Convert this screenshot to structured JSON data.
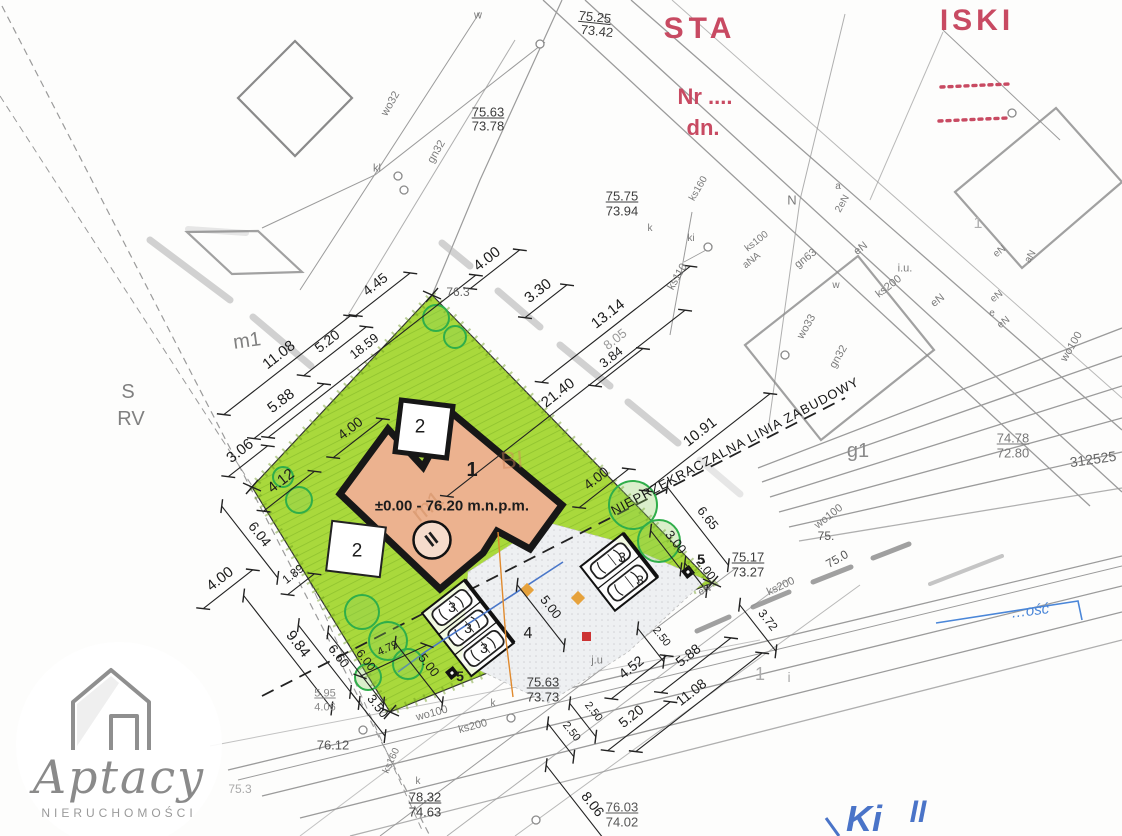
{
  "meta": {
    "title": "site-plan-scan",
    "width": 1122,
    "height": 836
  },
  "colors": {
    "plot_green": "#a9d93c",
    "hatch_green": "#8fc22e",
    "border_hatch": "#68961a",
    "building_fill": "#ecb28f",
    "outline_black": "#171717",
    "stamp_red": "#c84a62",
    "blue_ink": "#4a74c8",
    "blue_box": "#4a86d8",
    "orange_line": "#e08a2e",
    "red_marker": "#cc3333",
    "survey_gray": "#9b9b9b",
    "dim_black": "#222222"
  },
  "logo": {
    "brand": "Aptacy",
    "subtitle": "NIERUCHOMOŚCI",
    "icon": "house-icon"
  },
  "building": {
    "number": "1",
    "level_text": "±0.00 - 76.20 m.n.p.m.",
    "storey_symbol": "II",
    "terrace_labels": [
      "2",
      "2"
    ],
    "parking_stall_label": "3",
    "driveway_label": "4",
    "lamp_label": "5"
  },
  "building_line_text": "NIEPRZEKRACZALNA LINIA ZABUDOWY",
  "trees": [
    {
      "cx": 436,
      "cy": 318,
      "r": 13
    },
    {
      "cx": 455,
      "cy": 337,
      "r": 11
    },
    {
      "cx": 283,
      "cy": 477,
      "r": 10
    },
    {
      "cx": 299,
      "cy": 500,
      "r": 13
    },
    {
      "cx": 362,
      "cy": 612,
      "r": 17
    },
    {
      "cx": 388,
      "cy": 641,
      "r": 19
    },
    {
      "cx": 408,
      "cy": 664,
      "r": 15
    },
    {
      "cx": 368,
      "cy": 677,
      "r": 13
    },
    {
      "cx": 633,
      "cy": 505,
      "r": 24
    },
    {
      "cx": 659,
      "cy": 541,
      "r": 21
    }
  ],
  "manholes": [
    [
      398,
      176
    ],
    [
      404,
      190
    ],
    [
      540,
      44
    ],
    [
      708,
      247
    ],
    [
      1012,
      113
    ],
    [
      785,
      355
    ],
    [
      363,
      730
    ],
    [
      511,
      718
    ],
    [
      536,
      820
    ]
  ],
  "labels": [
    {
      "t": "STA",
      "x": 700,
      "y": 29,
      "s": 30,
      "b": 1,
      "c": "#c84a62",
      "ls": 5,
      "n": "stamp-text-sta"
    },
    {
      "t": "ISKI",
      "x": 977,
      "y": 21,
      "s": 30,
      "b": 1,
      "c": "#c84a62",
      "ls": 4,
      "n": "stamp-text-iski"
    },
    {
      "t": "Nr ....",
      "x": 705,
      "y": 97,
      "s": 22,
      "b": 1,
      "c": "#c84a62",
      "n": "stamp-nr-label"
    },
    {
      "t": "dn.",
      "x": 703,
      "y": 128,
      "s": 22,
      "b": 1,
      "c": "#c84a62",
      "n": "stamp-date-label"
    },
    {
      "t": "75.25",
      "x": 595,
      "y": 17,
      "s": 13,
      "c": "#3c3c3c",
      "u": 1,
      "r": 6,
      "n": "elevation-label"
    },
    {
      "t": "73.42",
      "x": 597,
      "y": 31,
      "s": 13,
      "c": "#3c3c3c",
      "r": 6,
      "n": "elevation-label"
    },
    {
      "t": "75.63",
      "x": 488,
      "y": 112,
      "s": 13,
      "c": "#3c3c3c",
      "u": 1,
      "n": "elevation-label"
    },
    {
      "t": "73.78",
      "x": 488,
      "y": 126,
      "s": 13,
      "c": "#3c3c3c",
      "n": "elevation-label"
    },
    {
      "t": "75.75",
      "x": 622,
      "y": 196,
      "s": 13,
      "c": "#3c3c3c",
      "u": 1,
      "n": "elevation-label"
    },
    {
      "t": "73.94",
      "x": 622,
      "y": 211,
      "s": 13,
      "c": "#3c3c3c",
      "n": "elevation-label"
    },
    {
      "t": "75.63",
      "x": 543,
      "y": 682,
      "s": 13,
      "c": "#3c3c3c",
      "u": 1,
      "n": "elevation-label"
    },
    {
      "t": "73.73",
      "x": 543,
      "y": 697,
      "s": 13,
      "c": "#3c3c3c",
      "n": "elevation-label"
    },
    {
      "t": "78.32",
      "x": 425,
      "y": 797,
      "s": 13,
      "c": "#3c3c3c",
      "u": 1,
      "n": "elevation-label"
    },
    {
      "t": "74.63",
      "x": 425,
      "y": 812,
      "s": 13,
      "c": "#3c3c3c",
      "n": "elevation-label"
    },
    {
      "t": "76.03",
      "x": 622,
      "y": 807,
      "s": 13,
      "c": "#555555",
      "u": 1,
      "n": "elevation-label"
    },
    {
      "t": "74.02",
      "x": 622,
      "y": 822,
      "s": 13,
      "c": "#555555",
      "n": "elevation-label"
    },
    {
      "t": "75.17",
      "x": 748,
      "y": 557,
      "s": 13,
      "c": "#3c3c3c",
      "u": 1,
      "n": "elevation-label"
    },
    {
      "t": "73.27",
      "x": 748,
      "y": 572,
      "s": 13,
      "c": "#3c3c3c",
      "n": "elevation-label"
    },
    {
      "t": "74.78",
      "x": 1013,
      "y": 438,
      "s": 13,
      "c": "#777777",
      "u": 1,
      "n": "elevation-label"
    },
    {
      "t": "72.80",
      "x": 1013,
      "y": 453,
      "s": 13,
      "c": "#777777",
      "n": "elevation-label"
    },
    {
      "t": "5.95",
      "x": 325,
      "y": 694,
      "s": 11,
      "c": "#888888",
      "u": 1,
      "n": "elevation-label"
    },
    {
      "t": "4.06",
      "x": 325,
      "y": 708,
      "s": 11,
      "c": "#888888",
      "n": "elevation-label"
    },
    {
      "t": "76.12",
      "x": 333,
      "y": 745,
      "s": 13,
      "c": "#555555",
      "n": "elevation-label"
    },
    {
      "t": "76.3",
      "x": 458,
      "y": 292,
      "s": 12,
      "c": "#666666",
      "n": "elevation-label"
    },
    {
      "t": "75.",
      "x": 826,
      "y": 536,
      "s": 12,
      "c": "#555555",
      "n": "elevation-label"
    },
    {
      "t": "75.0",
      "x": 837,
      "y": 559,
      "s": 12,
      "c": "#555555",
      "r": -30,
      "n": "elevation-label"
    },
    {
      "t": "75.3",
      "x": 240,
      "y": 789,
      "s": 12,
      "c": "#aaaaaa",
      "n": "elevation-label"
    },
    {
      "t": "312525",
      "x": 1093,
      "y": 459,
      "s": 14,
      "c": "#666666",
      "r": -8,
      "n": "parcel-number"
    },
    {
      "t": "4.45",
      "x": 375,
      "y": 284,
      "s": 14,
      "r": -38,
      "d": 4.45,
      "n": "dimension-label"
    },
    {
      "t": "4.00",
      "x": 487,
      "y": 259,
      "s": 15,
      "r": -38,
      "d": 4.0,
      "n": "dimension-label"
    },
    {
      "t": "3.30",
      "x": 538,
      "y": 291,
      "s": 15,
      "r": -38,
      "d": 3.3,
      "n": "dimension-label"
    },
    {
      "t": "13.14",
      "x": 608,
      "y": 314,
      "s": 15,
      "r": -38,
      "d": 13.14,
      "n": "dimension-label"
    },
    {
      "t": "8.05",
      "x": 615,
      "y": 339,
      "s": 13,
      "c": "#999999",
      "r": -38,
      "n": "dimension-label"
    },
    {
      "t": "3.84",
      "x": 611,
      "y": 357,
      "s": 13,
      "r": -38,
      "d": 3.84,
      "n": "dimension-label"
    },
    {
      "t": "21.40",
      "x": 558,
      "y": 393,
      "s": 15,
      "r": -38,
      "d": 21.4,
      "n": "dimension-label"
    },
    {
      "t": "10.91",
      "x": 700,
      "y": 432,
      "s": 15,
      "r": -38,
      "d": 10.91,
      "n": "dimension-label"
    },
    {
      "t": "11.08",
      "x": 279,
      "y": 355,
      "s": 15,
      "r": -38,
      "d": 11.08,
      "n": "dimension-label"
    },
    {
      "t": "5.20",
      "x": 327,
      "y": 341,
      "s": 14,
      "r": -38,
      "d": 5.2,
      "n": "dimension-label"
    },
    {
      "t": "18.59",
      "x": 364,
      "y": 346,
      "s": 13,
      "r": -38,
      "d": 18.59,
      "n": "dimension-label"
    },
    {
      "t": "5.88",
      "x": 281,
      "y": 401,
      "s": 15,
      "r": -38,
      "d": 5.88,
      "n": "dimension-label"
    },
    {
      "t": "3.06",
      "x": 240,
      "y": 451,
      "s": 15,
      "r": -38,
      "d": 3.06,
      "n": "dimension-label"
    },
    {
      "t": "4.12",
      "x": 281,
      "y": 481,
      "s": 15,
      "r": -38,
      "d": 4.12,
      "n": "dimension-label"
    },
    {
      "t": "6.04",
      "x": 260,
      "y": 534,
      "s": 14,
      "r": 52,
      "d": 6.04,
      "n": "dimension-label"
    },
    {
      "t": "4.00",
      "x": 350,
      "y": 428,
      "s": 14,
      "r": -38,
      "d": 4.0,
      "n": "dimension-label"
    },
    {
      "t": "4.00",
      "x": 596,
      "y": 478,
      "s": 14,
      "r": -38,
      "d": 4.0,
      "n": "dimension-label"
    },
    {
      "t": "4.00",
      "x": 220,
      "y": 579,
      "s": 15,
      "r": -38,
      "d": 4.0,
      "n": "dimension-label"
    },
    {
      "t": "9.84",
      "x": 298,
      "y": 644,
      "s": 15,
      "r": 52,
      "d": 9.84,
      "n": "dimension-label"
    },
    {
      "t": "1.89",
      "x": 293,
      "y": 574,
      "s": 12,
      "r": -38,
      "d": 1.89,
      "n": "dimension-label"
    },
    {
      "t": "6.60",
      "x": 339,
      "y": 656,
      "s": 13,
      "r": 52,
      "d": 6.6,
      "n": "dimension-label"
    },
    {
      "t": "6.00",
      "x": 366,
      "y": 660,
      "s": 12,
      "r": 52,
      "d": 6.0,
      "n": "dimension-label"
    },
    {
      "t": "4.79",
      "x": 388,
      "y": 649,
      "s": 11,
      "r": -25,
      "d": 4.79,
      "n": "dimension-label"
    },
    {
      "t": "3.50",
      "x": 378,
      "y": 706,
      "s": 13,
      "r": 52,
      "d": 3.5,
      "n": "dimension-label"
    },
    {
      "t": "5.00",
      "x": 429,
      "y": 665,
      "s": 13,
      "r": 52,
      "d": 5.0,
      "n": "dimension-label"
    },
    {
      "t": "5.00",
      "x": 551,
      "y": 607,
      "s": 13,
      "r": 52,
      "d": 5.0,
      "n": "dimension-label"
    },
    {
      "t": "3.00",
      "x": 676,
      "y": 542,
      "s": 13,
      "r": 52,
      "d": 3.0,
      "n": "dimension-label"
    },
    {
      "t": "2.00",
      "x": 706,
      "y": 569,
      "s": 12,
      "r": 52,
      "d": 2.0,
      "n": "dimension-label"
    },
    {
      "t": "6.65",
      "x": 708,
      "y": 518,
      "s": 13,
      "r": 52,
      "d": 6.65,
      "n": "dimension-label"
    },
    {
      "t": "4.52",
      "x": 631,
      "y": 667,
      "s": 14,
      "r": -38,
      "d": 4.52,
      "n": "dimension-label"
    },
    {
      "t": "2.50",
      "x": 661,
      "y": 637,
      "s": 11,
      "r": 52,
      "d": 2.5,
      "n": "dimension-label"
    },
    {
      "t": "2.50",
      "x": 593,
      "y": 712,
      "s": 11,
      "r": 52,
      "d": 2.5,
      "n": "dimension-label"
    },
    {
      "t": "2.50",
      "x": 571,
      "y": 732,
      "s": 11,
      "r": 52,
      "d": 2.5,
      "n": "dimension-label"
    },
    {
      "t": "3.72",
      "x": 768,
      "y": 620,
      "s": 12,
      "r": 52,
      "d": 3.72,
      "n": "dimension-label"
    },
    {
      "t": "5.88",
      "x": 688,
      "y": 655,
      "s": 14,
      "r": -38,
      "d": 5.88,
      "n": "dimension-label"
    },
    {
      "t": "5.20",
      "x": 631,
      "y": 716,
      "s": 14,
      "r": -38,
      "d": 5.2,
      "n": "dimension-label"
    },
    {
      "t": "11.08",
      "x": 691,
      "y": 692,
      "s": 14,
      "r": -38,
      "d": 11.08,
      "n": "dimension-label"
    },
    {
      "t": "8.06",
      "x": 593,
      "y": 804,
      "s": 14,
      "r": 52,
      "d": 8.06,
      "n": "dimension-label"
    },
    {
      "t": "w",
      "x": 478,
      "y": 16,
      "s": 11,
      "c": "#7a7a7a",
      "n": "utility-label"
    },
    {
      "t": "kl",
      "x": 377,
      "y": 169,
      "s": 11,
      "c": "#7a7a7a",
      "n": "utility-label"
    },
    {
      "t": "wo32",
      "x": 391,
      "y": 104,
      "s": 11,
      "c": "#7a7a7a",
      "r": -60,
      "n": "utility-label"
    },
    {
      "t": "gn32",
      "x": 437,
      "y": 152,
      "s": 11,
      "c": "#7a7a7a",
      "r": -60,
      "n": "utility-label"
    },
    {
      "t": "ks160",
      "x": 699,
      "y": 189,
      "s": 10,
      "c": "#7a7a7a",
      "r": -60,
      "n": "utility-label"
    },
    {
      "t": "k",
      "x": 650,
      "y": 229,
      "s": 10,
      "c": "#7a7a7a",
      "n": "utility-label"
    },
    {
      "t": "ki",
      "x": 691,
      "y": 239,
      "s": 10,
      "c": "#7a7a7a",
      "n": "utility-label"
    },
    {
      "t": "ks110",
      "x": 678,
      "y": 277,
      "s": 11,
      "c": "#7a7a7a",
      "r": -60,
      "n": "utility-label"
    },
    {
      "t": "ks100",
      "x": 757,
      "y": 242,
      "s": 10,
      "c": "#7a7a7a",
      "r": -38,
      "n": "utility-label"
    },
    {
      "t": "aNA",
      "x": 752,
      "y": 261,
      "s": 10,
      "c": "#7a7a7a",
      "r": -38,
      "n": "utility-label"
    },
    {
      "t": "N",
      "x": 792,
      "y": 200,
      "s": 13,
      "c": "#7a7a7a",
      "n": "utility-label"
    },
    {
      "t": "a",
      "x": 838,
      "y": 187,
      "s": 10,
      "c": "#7a7a7a",
      "n": "utility-label"
    },
    {
      "t": "2eN",
      "x": 843,
      "y": 204,
      "s": 10,
      "c": "#7a7a7a",
      "r": -60,
      "n": "utility-label"
    },
    {
      "t": "eN",
      "x": 861,
      "y": 249,
      "s": 11,
      "c": "#7a7a7a",
      "r": -38,
      "n": "utility-label"
    },
    {
      "t": "gn63",
      "x": 806,
      "y": 259,
      "s": 11,
      "c": "#7a7a7a",
      "r": -38,
      "n": "utility-label"
    },
    {
      "t": "i.u.",
      "x": 905,
      "y": 269,
      "s": 11,
      "c": "#7a7a7a",
      "n": "utility-label"
    },
    {
      "t": "ks200",
      "x": 889,
      "y": 287,
      "s": 11,
      "c": "#7a7a7a",
      "r": -38,
      "n": "utility-label"
    },
    {
      "t": "eN",
      "x": 938,
      "y": 301,
      "s": 11,
      "c": "#7a7a7a",
      "r": -38,
      "n": "utility-label"
    },
    {
      "t": "w",
      "x": 836,
      "y": 286,
      "s": 10,
      "c": "#7a7a7a",
      "n": "utility-label"
    },
    {
      "t": "wo33",
      "x": 807,
      "y": 327,
      "s": 11,
      "c": "#7a7a7a",
      "r": -60,
      "n": "utility-label"
    },
    {
      "t": "gn32",
      "x": 839,
      "y": 357,
      "s": 11,
      "c": "#7a7a7a",
      "r": -60,
      "n": "utility-label"
    },
    {
      "t": "eN",
      "x": 1000,
      "y": 252,
      "s": 10,
      "c": "#7a7a7a",
      "r": -38,
      "n": "utility-label"
    },
    {
      "t": "aN",
      "x": 1031,
      "y": 257,
      "s": 10,
      "c": "#7a7a7a",
      "r": -60,
      "n": "utility-label"
    },
    {
      "t": "eN",
      "x": 997,
      "y": 297,
      "s": 10,
      "c": "#7a7a7a",
      "r": -38,
      "n": "utility-label"
    },
    {
      "t": "e",
      "x": 992,
      "y": 314,
      "s": 10,
      "c": "#7a7a7a",
      "n": "utility-label"
    },
    {
      "t": "eN",
      "x": 1004,
      "y": 323,
      "s": 10,
      "c": "#7a7a7a",
      "r": -38,
      "n": "utility-label"
    },
    {
      "t": "wo100",
      "x": 1072,
      "y": 347,
      "s": 11,
      "c": "#7a7a7a",
      "r": -60,
      "n": "utility-label"
    },
    {
      "t": "wo100",
      "x": 829,
      "y": 517,
      "s": 11,
      "c": "#7a7a7a",
      "r": -38,
      "n": "utility-label"
    },
    {
      "t": "ks200",
      "x": 781,
      "y": 587,
      "s": 11,
      "c": "#7a7a7a",
      "r": -25,
      "n": "utility-label"
    },
    {
      "t": "eN",
      "x": 705,
      "y": 591,
      "s": 10,
      "c": "#7a7a7a",
      "r": -25,
      "n": "utility-label"
    },
    {
      "t": "j.u",
      "x": 597,
      "y": 661,
      "s": 11,
      "c": "#7a7a7a",
      "n": "utility-label"
    },
    {
      "t": "k",
      "x": 493,
      "y": 704,
      "s": 10,
      "c": "#7a7a7a",
      "n": "utility-label"
    },
    {
      "t": "wo100",
      "x": 432,
      "y": 714,
      "s": 11,
      "c": "#7a7a7a",
      "r": -15,
      "n": "utility-label"
    },
    {
      "t": "ks200",
      "x": 473,
      "y": 727,
      "s": 11,
      "c": "#7a7a7a",
      "r": -15,
      "n": "utility-label"
    },
    {
      "t": "ks160",
      "x": 392,
      "y": 761,
      "s": 10,
      "c": "#7a7a7a",
      "r": -65,
      "n": "utility-label"
    },
    {
      "t": "k",
      "x": 418,
      "y": 782,
      "s": 10,
      "c": "#7a7a7a",
      "n": "utility-label"
    },
    {
      "t": "m1",
      "x": 247,
      "y": 341,
      "s": 20,
      "c": "#808080",
      "r": -8,
      "n": "zone-label"
    },
    {
      "t": "S",
      "x": 128,
      "y": 392,
      "s": 20,
      "c": "#808080",
      "n": "zone-label"
    },
    {
      "t": "RV",
      "x": 131,
      "y": 419,
      "s": 20,
      "c": "#808080",
      "n": "zone-label"
    },
    {
      "t": "g1",
      "x": 858,
      "y": 451,
      "s": 20,
      "c": "#8a8a8a",
      "n": "zone-label"
    },
    {
      "t": "1",
      "x": 760,
      "y": 674,
      "s": 18,
      "c": "#aaaaaa",
      "n": "zone-label"
    },
    {
      "t": "i",
      "x": 789,
      "y": 677,
      "s": 14,
      "c": "#aaaaaa",
      "n": "zone-label"
    },
    {
      "t": "1",
      "x": 978,
      "y": 224,
      "s": 16,
      "c": "#b0b0b0",
      "n": "zone-label"
    },
    {
      "t": "BI",
      "x": 512,
      "y": 461,
      "s": 24,
      "c": "#d1855a",
      "o": 0.45,
      "r": -5,
      "n": "ghost-zone-label"
    },
    {
      "t": "m1",
      "x": 428,
      "y": 507,
      "s": 24,
      "c": "#c27a4a",
      "o": 0.35,
      "r": -38,
      "n": "ghost-zone-label"
    },
    {
      "t": "NIEPRZEKRACZALNA LINIA ZABUDOWY",
      "x": 735,
      "y": 446,
      "s": 13,
      "r": -28,
      "ls": 1,
      "c": "#151515",
      "n": "building-line-label"
    },
    {
      "t": "1",
      "x": 472,
      "y": 470,
      "s": 20,
      "b": 1,
      "n": "building-number"
    },
    {
      "t": "±0.00 - 76.20 m.n.p.m.",
      "x": 452,
      "y": 506,
      "s": 15,
      "b": 1,
      "n": "building-level-text"
    },
    {
      "t": "II",
      "x": 432,
      "y": 540,
      "s": 19,
      "b": 1,
      "r": -38,
      "n": "storey-symbol"
    },
    {
      "t": "2",
      "x": 420,
      "y": 427,
      "s": 19,
      "n": "terrace-label"
    },
    {
      "t": "2",
      "x": 357,
      "y": 551,
      "s": 19,
      "n": "terrace-label"
    },
    {
      "t": "3",
      "x": 452,
      "y": 607,
      "s": 14,
      "n": "parking-stall-label"
    },
    {
      "t": "3",
      "x": 468,
      "y": 628,
      "s": 14,
      "n": "parking-stall-label"
    },
    {
      "t": "3",
      "x": 484,
      "y": 648,
      "s": 14,
      "n": "parking-stall-label"
    },
    {
      "t": "3",
      "x": 622,
      "y": 557,
      "s": 14,
      "n": "parking-stall-label"
    },
    {
      "t": "3",
      "x": 640,
      "y": 580,
      "s": 14,
      "n": "parking-stall-label"
    },
    {
      "t": "4",
      "x": 528,
      "y": 634,
      "s": 16,
      "n": "driveway-label"
    },
    {
      "t": "5",
      "x": 460,
      "y": 676,
      "s": 14,
      "b": 1,
      "n": "lamp-label"
    },
    {
      "t": "5",
      "x": 701,
      "y": 559,
      "s": 14,
      "b": 1,
      "n": "lamp-label"
    },
    {
      "t": "…ość",
      "x": 1030,
      "y": 611,
      "s": 15,
      "c": "#4a86d8",
      "r": -7,
      "i": 1,
      "n": "blue-box-text"
    },
    {
      "t": "Ki",
      "x": 864,
      "y": 819,
      "s": 36,
      "c": "#4a74c8",
      "i": 1,
      "b": 1,
      "n": "signature-text"
    },
    {
      "t": "ll",
      "x": 918,
      "y": 813,
      "s": 30,
      "c": "#4a74c8",
      "i": 1,
      "b": 1,
      "n": "signature-text"
    }
  ]
}
